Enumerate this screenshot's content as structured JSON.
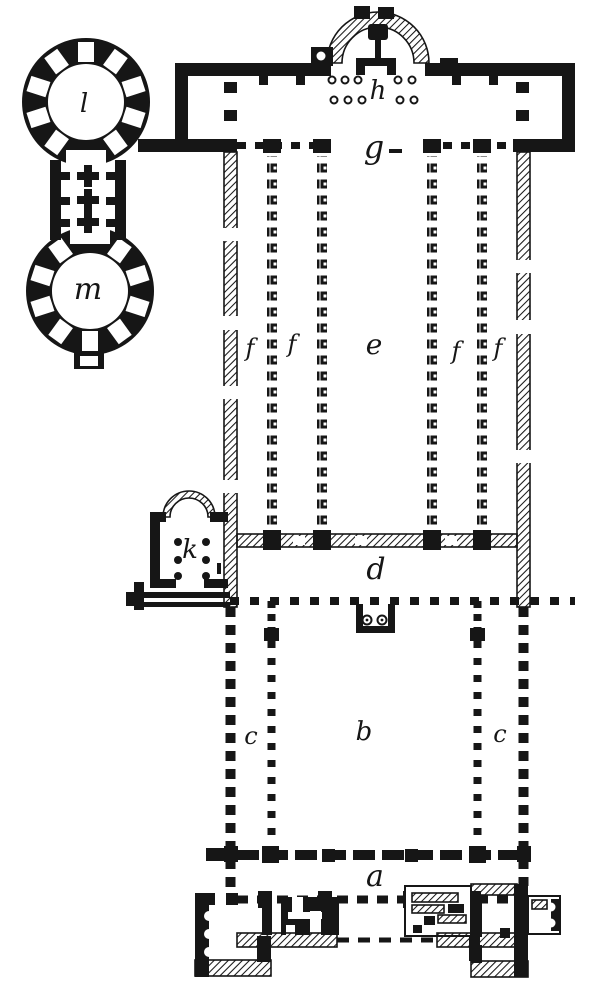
{
  "figure": {
    "colors": {
      "ink": "#161616",
      "paper": "#ffffff"
    }
  },
  "labels": [
    {
      "id": "rotunda-upper",
      "char": "l"
    },
    {
      "id": "rotunda-lower",
      "char": "m"
    },
    {
      "id": "altar-area",
      "char": "h"
    },
    {
      "id": "transept",
      "char": "g"
    },
    {
      "id": "aisle-outer-left",
      "char": "f"
    },
    {
      "id": "aisle-inner-left",
      "char": "f"
    },
    {
      "id": "nave",
      "char": "e"
    },
    {
      "id": "aisle-inner-right",
      "char": "f"
    },
    {
      "id": "aisle-outer-right",
      "char": "f"
    },
    {
      "id": "side-chapel",
      "char": "k"
    },
    {
      "id": "narthex",
      "char": "d"
    },
    {
      "id": "atrium-colonnade-left",
      "char": "c"
    },
    {
      "id": "atrium-court",
      "char": "b"
    },
    {
      "id": "atrium-colonnade-right",
      "char": "c"
    },
    {
      "id": "entrance-hall",
      "char": "a"
    }
  ]
}
